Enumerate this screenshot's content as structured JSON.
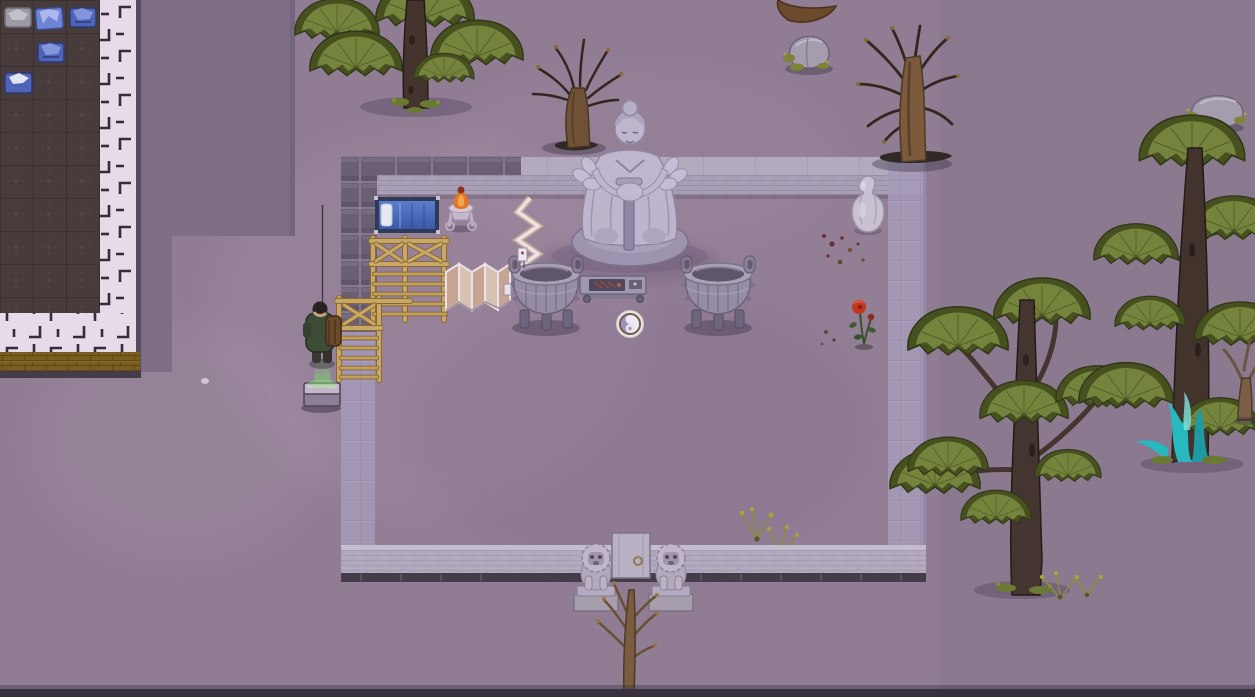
{
  "scene": {
    "type": "top-down colony-sim game world, purple dusk tint",
    "visible_text": "none",
    "viewport": "1255x697"
  },
  "palette": {
    "ground": "#907d93",
    "ground_shadow": "#7d6d85",
    "room_floor": "#473c3b",
    "room_grid": "#3a302f",
    "path_tile": "#e7dbe9",
    "path_mark": "#342c38",
    "gold_wall": "#7b5d20",
    "wall_block": "#6b5f74",
    "wall_block_gap": "#857a92",
    "wall_brick": "#a89fb6",
    "wall_cap": "#b3aabf",
    "wall_translucent": "#a59ab8",
    "wall_bottom": "#b3aac0",
    "wall_base_dark": "#453c4a",
    "door": "#b9b1c3",
    "stone_light": "#c0b7d0",
    "stone_mid": "#a89fba",
    "cauldron_body": "#968ca6",
    "cauldron_rim": "#aaa1b8",
    "cauldron_mouth": "#5f566e",
    "wood": "#c9a766",
    "wood_dark": "#8a6a33",
    "screen_panel": "#c7a491",
    "screen_frame": "#e9e2e8",
    "bed_blue": "#4a6cb8",
    "bed_frame": "#2f3a56",
    "pillow": "#e6e8f2",
    "fire": "#e0762a",
    "fire_light": "#f2a64a",
    "pine_foliage": "#75843c",
    "pine_dark": "#46511f",
    "pine_trunk": "#45342d",
    "dead_trunk": "#7b5b3b",
    "branch": "#33261f",
    "teal_glow": "#28b8bf",
    "rose_red": "#bf3620",
    "beam_green": "#79d86a",
    "pawn_jacket": "#3e4b36",
    "backpack": "#6b4a2c",
    "apparel_blue": "#4f63b8",
    "apparel_gray": "#9a99a4",
    "grass_yellow": "#8b8d3f",
    "rock": "#a59cae",
    "moss": "#7d8435",
    "yinyang_purple": "#a08fbc",
    "yinyang_ring": "#6e5a48",
    "blood_stain": "#6b3036"
  },
  "entities": {
    "storage_area": {
      "label": "dark tiled storage floor (top-left building)",
      "bbox": [
        0,
        0,
        100,
        313
      ],
      "items": [
        {
          "name": "gray folded bundle",
          "bbox": [
            5,
            7,
            28,
            25
          ]
        },
        {
          "name": "blue folded trousers",
          "bbox": [
            35,
            7,
            28,
            25
          ]
        },
        {
          "name": "blue folded shirt",
          "bbox": [
            71,
            5,
            23,
            27
          ]
        },
        {
          "name": "blue folded shirt",
          "bbox": [
            38,
            40,
            25,
            23
          ]
        },
        {
          "name": "blue folded shirt",
          "bbox": [
            5,
            71,
            27,
            23
          ]
        }
      ]
    },
    "tile_path": {
      "label": "pale ornamental tile path, L-shaped border",
      "bbox": [
        0,
        0,
        141,
        378
      ]
    },
    "gold_brick_wall": {
      "label": "gold brick wall strip",
      "bbox": [
        0,
        352,
        140,
        20
      ]
    },
    "shadow_zone": {
      "label": "dark roof-shadow zone",
      "bbox": [
        137,
        0,
        158,
        372
      ]
    },
    "courtyard": {
      "label": "walled temple courtyard",
      "bbox": [
        341,
        152,
        585,
        430
      ],
      "door": {
        "label": "stone door with ring handle",
        "bbox": [
          612,
          533,
          38,
          45
        ]
      },
      "statue": {
        "label": "large stone monk statue resting on sword",
        "bbox": [
          570,
          98,
          120,
          168
        ]
      },
      "guardian_lion_left": {
        "bbox": [
          573,
          538,
          45,
          72
        ]
      },
      "guardian_lion_right": {
        "bbox": [
          648,
          538,
          45,
          72
        ]
      },
      "cauldron_left": {
        "label": "bronze ding cauldron",
        "bbox": [
          512,
          262,
          68,
          68
        ]
      },
      "cauldron_right": {
        "label": "bronze ding cauldron",
        "bbox": [
          684,
          262,
          68,
          68
        ]
      },
      "altar_table": {
        "label": "low altar table with offerings",
        "bbox": [
          580,
          276,
          66,
          26
        ]
      },
      "yinyang_plate": {
        "label": "yin-yang medallion on floor",
        "bbox": [
          617,
          311,
          27,
          26
        ]
      },
      "vase": {
        "label": "pale stone vase",
        "bbox": [
          852,
          175,
          32,
          57
        ]
      },
      "rose": {
        "label": "red rose bush",
        "bbox": [
          848,
          298,
          32,
          48
        ]
      },
      "bed": {
        "label": "blue single bed with pillow",
        "bbox": [
          375,
          197,
          64,
          36
        ]
      },
      "fire_basket": {
        "label": "burning fire basket on stand",
        "bbox": [
          448,
          188,
          26,
          42
        ]
      },
      "trellis_large": {
        "label": "wooden trellis frame",
        "bbox": [
          370,
          238,
          77,
          82
        ]
      },
      "trellis_small": {
        "label": "wooden trellis frame",
        "bbox": [
          336,
          296,
          46,
          86
        ]
      },
      "folding_screen": {
        "label": "folding screen",
        "bbox": [
          446,
          262,
          62,
          48
        ]
      },
      "zigzag_screen": {
        "label": "tall zigzag screen",
        "bbox": [
          516,
          196,
          26,
          114
        ]
      },
      "grass_tufts": {
        "bbox": [
          744,
          505,
          52,
          48
        ]
      },
      "floor_stains": {
        "label": "dark red stains",
        "bbox": [
          818,
          228,
          52,
          40
        ]
      }
    },
    "pawn": {
      "label": "colonist in green outfit with bedroll, holding pole",
      "bbox": [
        304,
        300,
        40,
        66
      ]
    },
    "stone_slab": {
      "label": "stone slab under green beam",
      "bbox": [
        303,
        380,
        38,
        30
      ]
    },
    "trees": [
      {
        "name": "large pine",
        "bbox": [
          300,
          0,
          215,
          115
        ]
      },
      {
        "name": "dead tree",
        "bbox": [
          528,
          40,
          100,
          115
        ]
      },
      {
        "name": "dead tree",
        "bbox": [
          852,
          18,
          115,
          150
        ]
      },
      {
        "name": "pine",
        "bbox": [
          885,
          280,
          235,
          315
        ]
      },
      {
        "name": "tall pine with teal glow",
        "bbox": [
          1095,
          120,
          160,
          350
        ]
      },
      {
        "name": "small bare tree",
        "bbox": [
          1228,
          335,
          27,
          85
        ]
      },
      {
        "name": "dead sapling at gate",
        "bbox": [
          592,
          578,
          76,
          119
        ]
      }
    ],
    "rocks": [
      {
        "name": "mossy boulder",
        "bbox": [
          786,
          36,
          45,
          36
        ]
      },
      {
        "name": "mossy boulder",
        "bbox": [
          1188,
          96,
          58,
          36
        ]
      }
    ],
    "grass_outside": {
      "bbox": [
        1040,
        574,
        65,
        26
      ]
    }
  }
}
